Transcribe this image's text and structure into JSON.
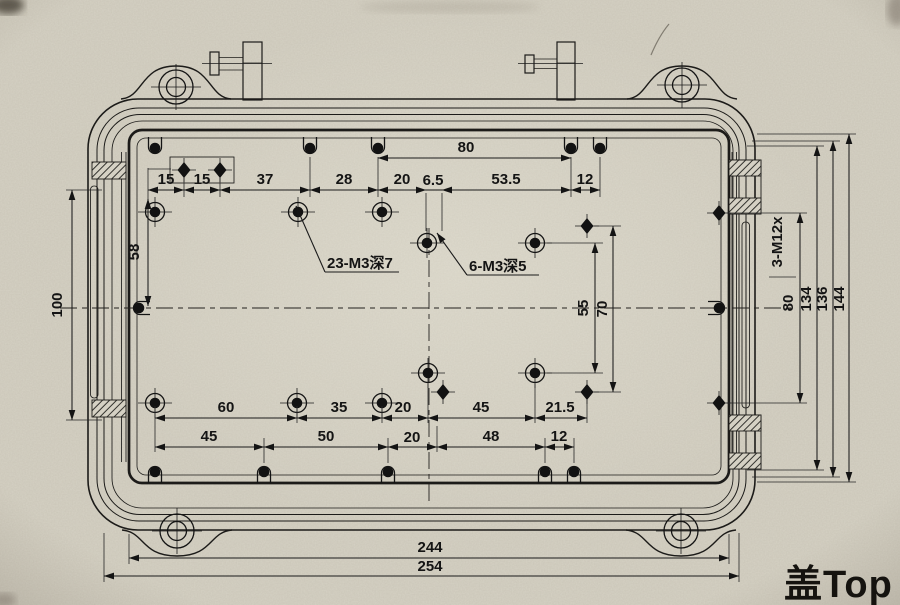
{
  "meta": {
    "part_label": "盖Top",
    "drawing_type": "enclosure-cover-top-view"
  },
  "colors": {
    "paper": "#d5d1c4",
    "ink": "#1b1b1b"
  },
  "notes": {
    "thread_23": "23-M3深7",
    "thread_6": "6-M3深5",
    "gland": "3-M12x"
  },
  "dims": {
    "top_span": "80",
    "top_chain": [
      "15",
      "15",
      "37",
      "28",
      "20",
      "6.5",
      "53.5",
      "12"
    ],
    "left_vert": [
      "58",
      "100"
    ],
    "center_vert": [
      "55",
      "70"
    ],
    "right_vert": [
      "80",
      "134",
      "136",
      "144"
    ],
    "bottom_row1": [
      "60",
      "35",
      "20",
      "45",
      "21.5"
    ],
    "bottom_row2": [
      "45",
      "50",
      "20",
      "48",
      "12"
    ],
    "overall": [
      "244",
      "254"
    ]
  }
}
